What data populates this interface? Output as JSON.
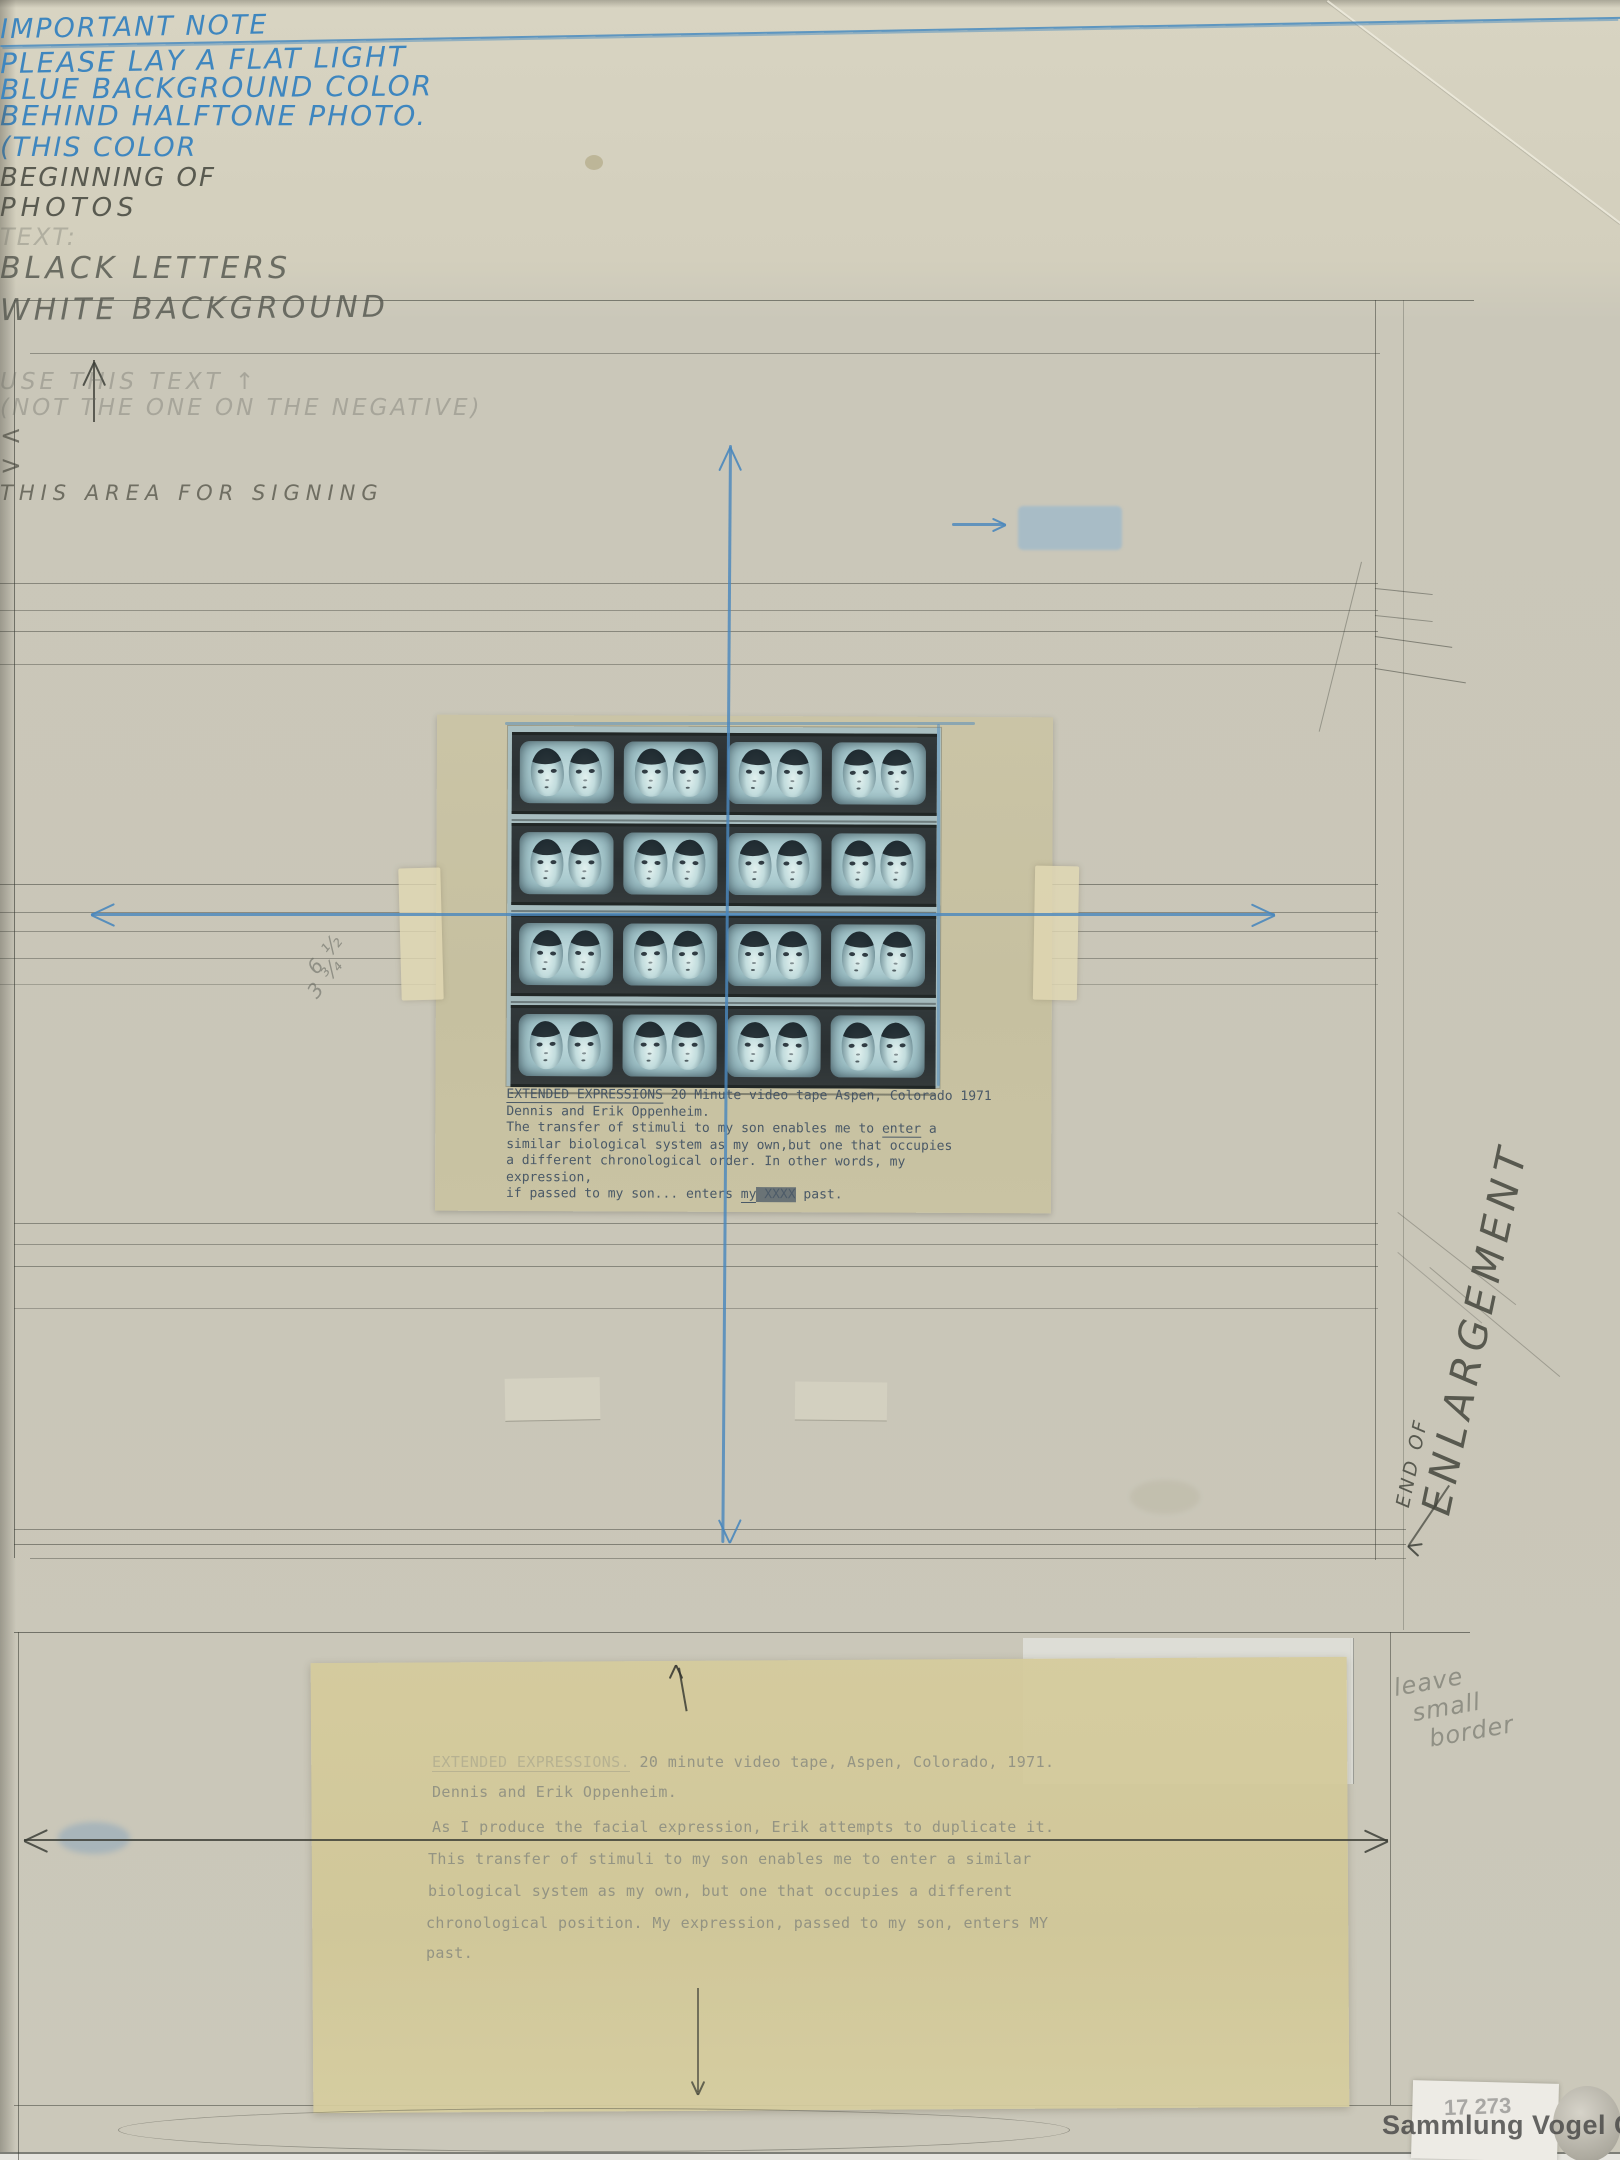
{
  "notes_blue": {
    "heading": "IMPORTANT NOTE",
    "line1": "PLEASE LAY A FLAT LIGHT",
    "line2": "BLUE BACKGROUND COLOR",
    "line3": "BEHIND HALFTONE PHOTO.",
    "line4": "(THIS COLOR",
    "swatch_color": "#8db4d2"
  },
  "notes_pencil": {
    "beginning_line1": "BEGINNING OF",
    "beginning_line2": "PHOTOS",
    "end_enlargement_small": "END OF",
    "end_enlargement_big": "ENLARGEMENT",
    "text_spec_prefix": "TEXT:",
    "text_spec_line1": "BLACK LETTERS",
    "text_spec_line2": "WHITE BACKGROUND",
    "margin_line1": "leave",
    "margin_line2": "small",
    "margin_line3": "border",
    "measure_top": "6 ½",
    "measure_bottom": "3 ¾",
    "use_text_line1": "USE THIS TEXT ↑",
    "use_text_line2": "(NOT THE ONE ON THE NEGATIVE)",
    "signing_label": "THIS AREA FOR SIGNING",
    "signing_arrow_left": "<",
    "signing_arrow_right": ">"
  },
  "photo": {
    "filmstrip": {
      "rows": 4,
      "frames_per_row": 4
    },
    "caption": {
      "title": "EXTENDED EXPRESSIONS",
      "title_rest": " 20 Minute video tape  Aspen, Colorado  1971",
      "line2": "Dennis and Erik Oppenheim.",
      "line3_pre": "The transfer of stimuli to my son enables me to ",
      "line3_u": "enter",
      "line3_post": " a",
      "line4": "similar biological system as my own,but one that occupies",
      "line5": "a different chronological order.  In other words, my expression,",
      "line6_pre": "if passed to my son... enters ",
      "line6_u": "my",
      "line6_strike": " XXXX",
      "line6_post": " past."
    }
  },
  "typed_sheet": {
    "line1_title": "EXTENDED EXPRESSIONS.",
    "line1_rest": " 20 minute video tape, Aspen, Colorado, 1971.",
    "lines": [
      "Dennis and Erik Oppenheim.",
      "As I produce the facial expression, Erik attempts to duplicate it.",
      "This transfer of stimuli to my son enables me to enter a similar",
      "biological system as my own, but one that occupies a different",
      "chronological position. My expression, passed to my son, enters MY",
      "past."
    ]
  },
  "collection_mark": {
    "watermark": "Sammlung Vogel C&C",
    "inventory_number": "17 273"
  }
}
